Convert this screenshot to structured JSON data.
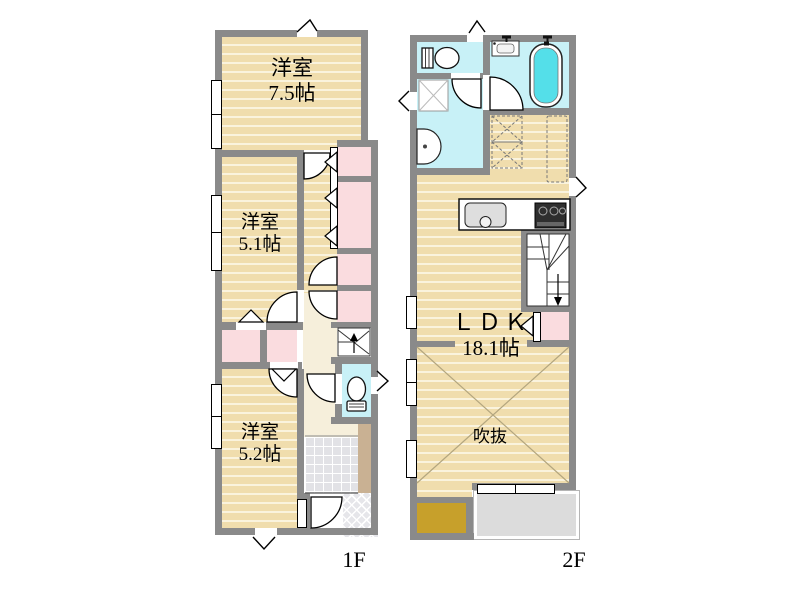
{
  "floor1": {
    "label": "1F",
    "rooms": [
      {
        "name": "洋室",
        "size": "7.5帖"
      },
      {
        "name": "洋室",
        "size": "5.1帖"
      },
      {
        "name": "洋室",
        "size": "5.2帖"
      }
    ]
  },
  "floor2": {
    "label": "2F",
    "ldk_name": "ＬＤＫ",
    "ldk_size": "18.1帖",
    "void_label": "吹抜"
  },
  "icons": [
    "toilet-icon",
    "bathtub-icon",
    "bath-sink-icon",
    "vanity-icon",
    "washing-machine-pan-icon",
    "kitchen-sink-icon",
    "stove-icon",
    "stairs-up-icon",
    "stairs-down-icon",
    "door-swing-arc",
    "folding-door-triangle",
    "window-break-mark"
  ],
  "colors": {
    "wall": "#8a8a8a",
    "tatami_floor": "#f0ddad",
    "tatami_stripe": "#faf3dd",
    "closet_pink": "#fadcdf",
    "sanitary_cyan": "#c8f1f7",
    "bathtub_cyan": "#54dfe9",
    "hall_cream": "#f6efdb",
    "entry_tile": "#e2e2e6",
    "balcony_gray": "#dcdcdc",
    "accent_mustard": "#c7a02b",
    "shoe_cabinet_tan": "#c9b193"
  }
}
